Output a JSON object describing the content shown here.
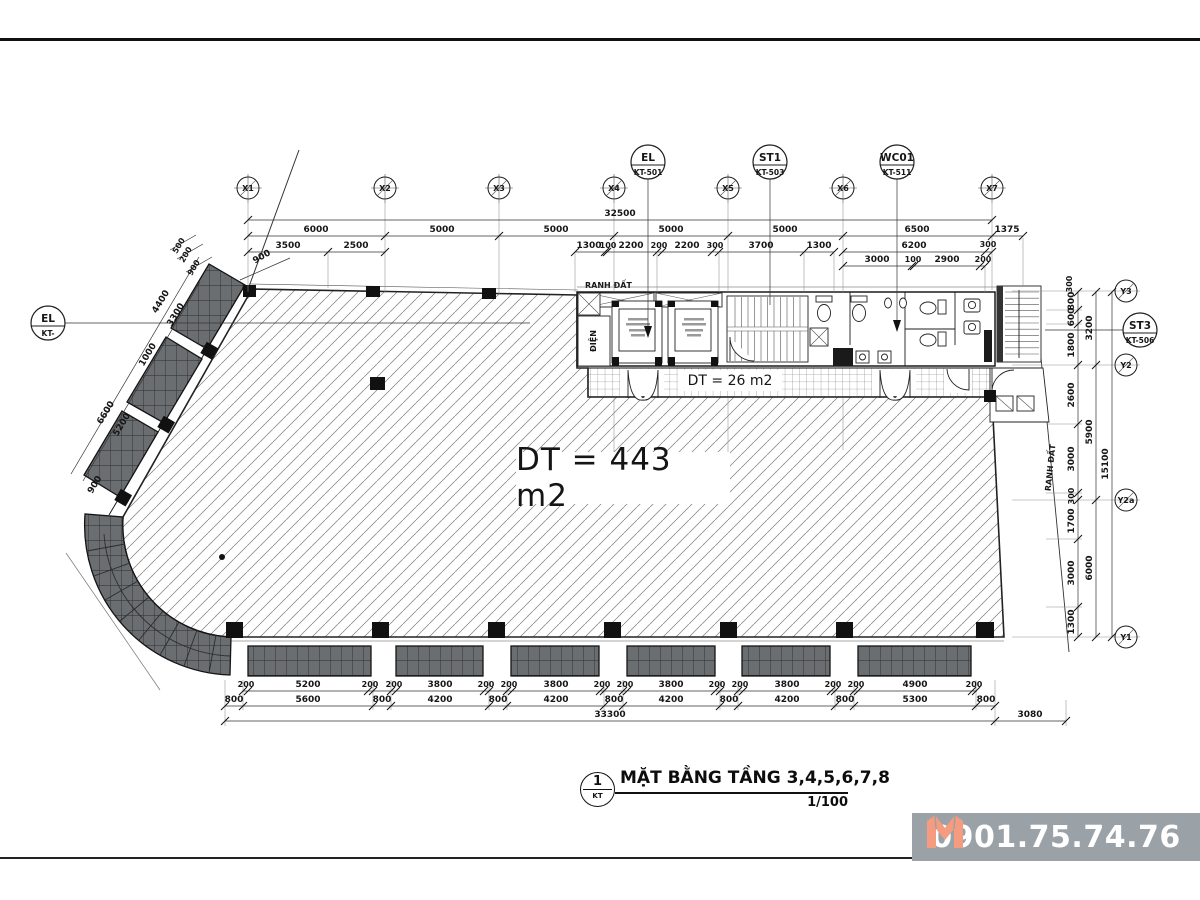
{
  "title_block": {
    "number": "1",
    "discipline": "KT",
    "title": "MẶT BẰNG TẦNG 3,4,5,6,7,8",
    "scale": "1/100"
  },
  "areas": {
    "main": "DT = 443 m2",
    "corridor": "DT = 26 m2"
  },
  "labels": {
    "boundary": "RANH ĐẤT",
    "electrical": "ĐIỆN"
  },
  "callouts": {
    "el_top": {
      "name": "EL",
      "ref": "KT-501"
    },
    "st1": {
      "name": "ST1",
      "ref": "KT-503"
    },
    "wc01": {
      "name": "WC01",
      "ref": "KT-511"
    },
    "el_left": {
      "name": "EL",
      "ref": "KT-"
    },
    "st3": {
      "name": "ST3",
      "ref": "KT-506"
    }
  },
  "grid": {
    "x": [
      "X1",
      "X2",
      "X3",
      "X4",
      "X5",
      "X6",
      "X7"
    ],
    "y": [
      "Y1",
      "Y2a",
      "Y2",
      "Y3"
    ]
  },
  "dims": {
    "top": {
      "overall": "32500",
      "row2": [
        "6000",
        "5000",
        "5000",
        "5000",
        "5000",
        "6500"
      ],
      "offset_right": "1375",
      "row3_left": [
        "3500",
        "2500"
      ],
      "row3_mid": [
        "1300",
        "100",
        "2200",
        "200",
        "2200",
        "300",
        "3700",
        "1300"
      ],
      "row3_right": "6200",
      "row3_small": "300",
      "row4": [
        "3000",
        "100",
        "2900",
        "200"
      ]
    },
    "bottom": {
      "row1": [
        "200",
        "5200",
        "200",
        "200",
        "3800",
        "200",
        "200",
        "3800",
        "200",
        "200",
        "3800",
        "200",
        "200",
        "3800",
        "200",
        "200",
        "4900",
        "200"
      ],
      "row2": [
        "800",
        "5600",
        "800",
        "4200",
        "800",
        "4200",
        "800",
        "4200",
        "800",
        "4200",
        "800",
        "5300",
        "800"
      ],
      "overall": "33300",
      "right_offset": "3080"
    },
    "right": {
      "row1": [
        "800",
        "600",
        "1800",
        "2600",
        "3000",
        "300",
        "1700",
        "3000",
        "1300"
      ],
      "row2": [
        "3200",
        "5900",
        "6000"
      ],
      "overall": "15100",
      "top_small": "300"
    },
    "left": [
      "500",
      "200",
      "900",
      "900",
      "4400",
      "3300",
      "1000",
      "6600",
      "5200",
      "900"
    ]
  },
  "branding": {
    "phone": "0901.75.74.76"
  },
  "colors": {
    "banner_bg": "#9aa1a7",
    "logo": "#f59c80",
    "phone_text": "#ffffff",
    "paper": "#ffffff",
    "ink": "#1a1a1a"
  }
}
